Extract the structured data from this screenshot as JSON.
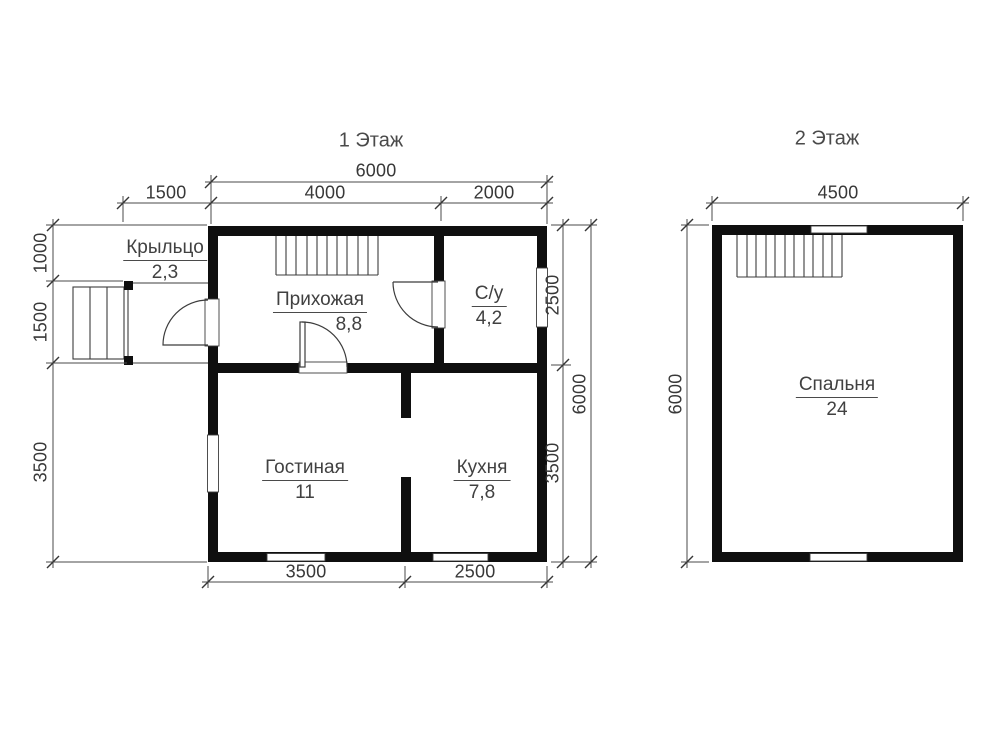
{
  "floor1": {
    "title": "1 Этаж",
    "rooms": [
      {
        "name": "Крыльцо",
        "area": "2,3"
      },
      {
        "name": "Прихожая",
        "area": "8,8"
      },
      {
        "name": "С/у",
        "area": "4,2"
      },
      {
        "name": "Гостиная",
        "area": "11"
      },
      {
        "name": "Кухня",
        "area": "7,8"
      }
    ],
    "dims": {
      "width_total": "6000",
      "width_hall": "4000",
      "width_bathroom": "2000",
      "porch_width": "1500",
      "left_top": "1000",
      "left_mid": "1500",
      "left_bottom": "3500",
      "right_top": "2500",
      "right_bottom": "3500",
      "height_total": "6000",
      "bottom_left": "3500",
      "bottom_right": "2500"
    }
  },
  "floor2": {
    "title": "2 Этаж",
    "rooms": [
      {
        "name": "Спальня",
        "area": "24"
      }
    ],
    "dims": {
      "width_total": "4500",
      "height_total": "6000"
    }
  },
  "colors": {
    "wall": "#0f0f0f",
    "thin_line": "#3c3c3c",
    "dim_line": "#4a4a4a"
  }
}
